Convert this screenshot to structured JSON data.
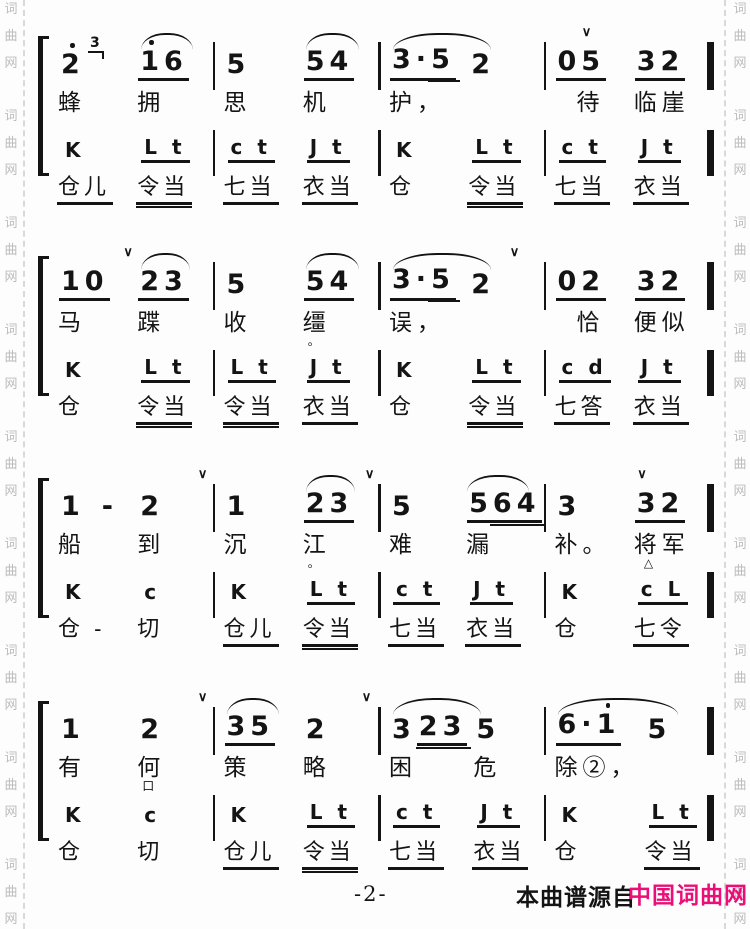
{
  "footer": {
    "page_number": "-2-",
    "source_label": "本曲谱源自",
    "brand": "中国词曲网"
  },
  "colors": {
    "ink": "#141414",
    "brand": "#ea0f78",
    "watermark": "#bcbcbc"
  },
  "watermark": {
    "text": "词曲网",
    "repeat": 9
  },
  "symbols": {
    "breath": "∨",
    "octave_dot": "high",
    "pause_triangle": "△",
    "aside_box": "口"
  },
  "lyrics_lines": [
    "蜂拥思机护，待临崖",
    "马蹀收缰误，恰便似",
    "船到沉江难漏补。将军",
    "有何策略困危除②，"
  ],
  "systems": [
    {
      "measures": [
        {
          "slurs": [
            {
              "left": "56%",
              "width": "33%"
            }
          ],
          "breaths": [],
          "beats": [
            {
              "note": [
                {
                  "t": "2",
                  "hi": [
                    0
                  ],
                  "grace": "3"
                }
              ],
              "lyric": {
                "t": "蜂"
              },
              "perc": {
                "t": "K",
                "u": 0
              },
              "syll": {
                "t": "仓儿",
                "u": 1
              }
            },
            {
              "note": [
                {
                  "t": "16",
                  "hi": [
                    0
                  ],
                  "u": 1
                }
              ],
              "lyric": {
                "t": "拥"
              },
              "perc": {
                "t": "L t",
                "u": 1
              },
              "syll": {
                "t": "令当",
                "u": 2
              }
            }
          ]
        },
        {
          "slurs": [
            {
              "left": "56%",
              "width": "33%"
            }
          ],
          "breaths": [],
          "beats": [
            {
              "note": [
                {
                  "t": "5"
                }
              ],
              "lyric": {
                "t": "思"
              },
              "perc": {
                "t": "c t",
                "u": 1
              },
              "syll": {
                "t": "七当",
                "u": 1
              }
            },
            {
              "note": [
                {
                  "t": "54",
                  "u": 1
                }
              ],
              "lyric": {
                "t": "机"
              },
              "perc": {
                "t": "J t",
                "u": 1
              },
              "syll": {
                "t": "衣当",
                "u": 1
              }
            }
          ]
        },
        {
          "slurs": [
            {
              "left": "6%",
              "width": "62%"
            }
          ],
          "breaths": [],
          "beats": [
            {
              "note": [
                {
                  "t": "3.5",
                  "u": 1,
                  "d2": "5"
                }
              ],
              "lyric": {
                "t": "护，"
              },
              "perc": {
                "t": "K",
                "u": 0
              },
              "syll": {
                "t": "仓",
                "u": 0
              }
            },
            {
              "note": [
                {
                  "t": "2"
                }
              ],
              "lyric": {
                "t": ""
              },
              "perc": {
                "t": "L t",
                "u": 1
              },
              "syll": {
                "t": "令当",
                "u": 2
              }
            }
          ]
        },
        {
          "slurs": [],
          "breaths": [
            {
              "left": "21%"
            }
          ],
          "beats": [
            {
              "note": [
                {
                  "t": "05",
                  "u": 1
                }
              ],
              "lyric": {
                "t": "待",
                "ind": 28
              },
              "perc": {
                "t": "c t",
                "u": 1
              },
              "syll": {
                "t": "七当",
                "u": 1
              }
            },
            {
              "note": [
                {
                  "t": "32",
                  "u": 1
                }
              ],
              "lyric": {
                "t": "临崖"
              },
              "perc": {
                "t": "J t",
                "u": 1
              },
              "syll": {
                "t": "衣当",
                "u": 1
              }
            }
          ]
        }
      ]
    },
    {
      "measures": [
        {
          "slurs": [
            {
              "left": "56%",
              "width": "31%"
            }
          ],
          "breaths": [
            {
              "left": "45%"
            }
          ],
          "beats": [
            {
              "note": [
                {
                  "t": "10",
                  "u": 1
                }
              ],
              "lyric": {
                "t": "马"
              },
              "perc": {
                "t": "K",
                "u": 0
              },
              "syll": {
                "t": "仓",
                "u": 0
              }
            },
            {
              "note": [
                {
                  "t": "23",
                  "u": 1
                }
              ],
              "lyric": {
                "t": "蹀"
              },
              "perc": {
                "t": "L t",
                "u": 1
              },
              "syll": {
                "t": "令当",
                "u": 2
              }
            }
          ]
        },
        {
          "slurs": [
            {
              "left": "56%",
              "width": "33%"
            }
          ],
          "breaths": [],
          "beats": [
            {
              "note": [
                {
                  "t": "5"
                }
              ],
              "lyric": {
                "t": "收"
              },
              "perc": {
                "t": "L t",
                "u": 1
              },
              "syll": {
                "t": "令当",
                "u": 2
              }
            },
            {
              "note": [
                {
                  "t": "54",
                  "u": 1
                }
              ],
              "lyric": {
                "t": "缰",
                "sub": "。"
              },
              "perc": {
                "t": "J t",
                "u": 1
              },
              "syll": {
                "t": "衣当",
                "u": 1
              }
            }
          ]
        },
        {
          "slurs": [
            {
              "left": "6%",
              "width": "62%"
            }
          ],
          "breaths": [
            {
              "left": "80%"
            }
          ],
          "beats": [
            {
              "note": [
                {
                  "t": "3.5",
                  "u": 1,
                  "d2": "5"
                }
              ],
              "lyric": {
                "t": "误，"
              },
              "perc": {
                "t": "K",
                "u": 0
              },
              "syll": {
                "t": "仓",
                "u": 0
              }
            },
            {
              "note": [
                {
                  "t": "2"
                }
              ],
              "lyric": {
                "t": ""
              },
              "perc": {
                "t": "L t",
                "u": 1
              },
              "syll": {
                "t": "令当",
                "u": 2
              }
            }
          ]
        },
        {
          "slurs": [],
          "breaths": [],
          "beats": [
            {
              "note": [
                {
                  "t": "02",
                  "u": 1
                }
              ],
              "lyric": {
                "t": "恰",
                "ind": 28
              },
              "perc": {
                "t": "c d",
                "u": 1
              },
              "syll": {
                "t": "七答",
                "u": 1
              }
            },
            {
              "note": [
                {
                  "t": "32",
                  "u": 1
                }
              ],
              "lyric": {
                "t": "便似"
              },
              "perc": {
                "t": "J t",
                "u": 1
              },
              "syll": {
                "t": "衣当",
                "u": 1
              }
            }
          ]
        }
      ]
    },
    {
      "measures": [
        {
          "slurs": [],
          "breaths": [
            {
              "left": "92%"
            }
          ],
          "beats": [
            {
              "note": [
                {
                  "t": "1"
                },
                {
                  "t": "-",
                  "dash": true
                }
              ],
              "lyric": {
                "t": "船"
              },
              "perc": {
                "t": "K",
                "u": 0
              },
              "syll": {
                "t": "仓 -",
                "u": 0
              }
            },
            {
              "note": [
                {
                  "t": "2"
                }
              ],
              "lyric": {
                "t": "到"
              },
              "perc": {
                "t": "c",
                "u": 0
              },
              "syll": {
                "t": "切",
                "u": 0
              }
            }
          ]
        },
        {
          "slurs": [
            {
              "left": "56%",
              "width": "31%"
            }
          ],
          "breaths": [
            {
              "left": "93%"
            }
          ],
          "beats": [
            {
              "note": [
                {
                  "t": "1"
                }
              ],
              "lyric": {
                "t": "沉"
              },
              "perc": {
                "t": "K",
                "u": 0
              },
              "syll": {
                "t": "仓儿",
                "u": 1
              }
            },
            {
              "note": [
                {
                  "t": "23",
                  "u": 1
                }
              ],
              "lyric": {
                "t": "江",
                "sub": "。"
              },
              "perc": {
                "t": "L t",
                "u": 1
              },
              "syll": {
                "t": "令当",
                "u": 2
              }
            }
          ]
        },
        {
          "slurs": [
            {
              "left": "53%",
              "width": "39%"
            }
          ],
          "breaths": [],
          "beats": [
            {
              "note": [
                {
                  "t": "5"
                }
              ],
              "lyric": {
                "t": "难"
              },
              "perc": {
                "t": "c t",
                "u": 1
              },
              "syll": {
                "t": "七当",
                "u": 1
              }
            },
            {
              "note": [
                {
                  "t": "564",
                  "u": 1,
                  "d2": "64"
                }
              ],
              "lyric": {
                "t": "漏"
              },
              "perc": {
                "t": "J t",
                "u": 1
              },
              "syll": {
                "t": "衣当",
                "u": 1
              }
            }
          ]
        },
        {
          "slurs": [],
          "breaths": [
            {
              "left": "56%"
            }
          ],
          "beats": [
            {
              "note": [
                {
                  "t": "3"
                }
              ],
              "lyric": {
                "t": "补。"
              },
              "perc": {
                "t": "K",
                "u": 0
              },
              "syll": {
                "t": "仓",
                "u": 0
              }
            },
            {
              "note": [
                {
                  "t": "32",
                  "u": 1
                }
              ],
              "lyric": {
                "t": "将军",
                "sub": "△"
              },
              "perc": {
                "t": "c L",
                "u": 1
              },
              "syll": {
                "t": "七令",
                "u": 1
              }
            }
          ]
        }
      ]
    },
    {
      "measures": [
        {
          "slurs": [],
          "breaths": [
            {
              "left": "92%"
            }
          ],
          "beats": [
            {
              "note": [
                {
                  "t": "1"
                }
              ],
              "lyric": {
                "t": "有"
              },
              "perc": {
                "t": "K",
                "u": 0
              },
              "syll": {
                "t": "仓",
                "u": 0
              }
            },
            {
              "note": [
                {
                  "t": "2"
                }
              ],
              "lyric": {
                "t": "何",
                "sub": "口"
              },
              "perc": {
                "t": "c",
                "u": 0
              },
              "syll": {
                "t": "切",
                "u": 0
              }
            }
          ]
        },
        {
          "slurs": [
            {
              "left": "6%",
              "width": "33%"
            }
          ],
          "breaths": [
            {
              "left": "91%"
            }
          ],
          "beats": [
            {
              "note": [
                {
                  "t": "35",
                  "u": 1
                }
              ],
              "lyric": {
                "t": "策"
              },
              "perc": {
                "t": "K",
                "u": 0
              },
              "syll": {
                "t": "仓儿",
                "u": 1
              }
            },
            {
              "note": [
                {
                  "t": "2"
                }
              ],
              "lyric": {
                "t": "略"
              },
              "perc": {
                "t": "L t",
                "u": 1
              },
              "syll": {
                "t": "令当",
                "u": 2
              }
            }
          ]
        },
        {
          "slurs": [
            {
              "left": "6%",
              "width": "56%"
            }
          ],
          "breaths": [],
          "beats": [
            {
              "note": [
                {
                  "t": "3"
                },
                {
                  "t": "23",
                  "u": 1,
                  "d2": "23"
                }
              ],
              "lyric": {
                "t": "困"
              },
              "perc": {
                "t": "c t",
                "u": 1
              },
              "syll": {
                "t": "七当",
                "u": 1
              }
            },
            {
              "note": [
                {
                  "t": "5"
                }
              ],
              "lyric": {
                "t": "危"
              },
              "perc": {
                "t": "J t",
                "u": 1
              },
              "syll": {
                "t": "衣当",
                "u": 1
              }
            }
          ]
        },
        {
          "slurs": [
            {
              "left": "6%",
              "width": "76%"
            }
          ],
          "breaths": [],
          "beats": [
            {
              "note": [
                {
                  "t": "6.1",
                  "u": 1,
                  "hi": [
                    2
                  ]
                }
              ],
              "lyric": {
                "t": "除②，"
              },
              "perc": {
                "t": "K",
                "u": 0
              },
              "syll": {
                "t": "仓",
                "u": 0
              }
            },
            {
              "note": [
                {
                  "t": "5"
                }
              ],
              "lyric": {
                "t": ""
              },
              "perc": {
                "t": "L t",
                "u": 1
              },
              "syll": {
                "t": "令当",
                "u": 1
              }
            }
          ]
        }
      ]
    }
  ]
}
